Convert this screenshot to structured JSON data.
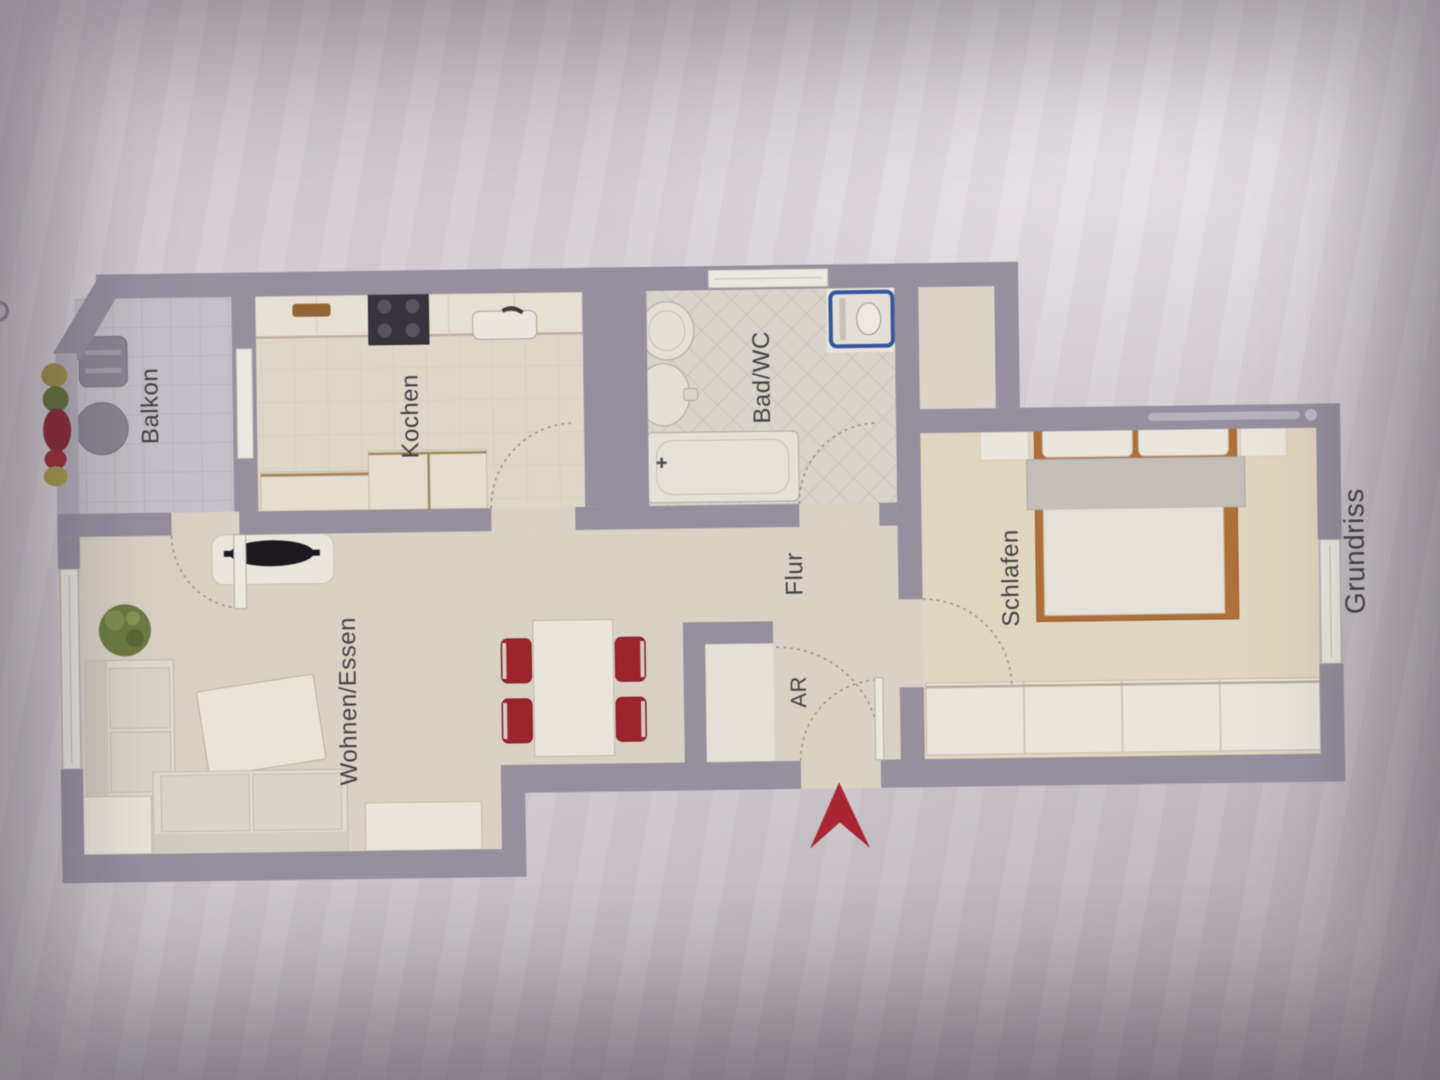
{
  "document": {
    "kind": "apartment-floor-plan-photo",
    "plan_title": "Grundriss"
  },
  "rooms": [
    {
      "id": "balkon",
      "label": "Balkon"
    },
    {
      "id": "kochen",
      "label": "Kochen"
    },
    {
      "id": "bad_wc",
      "label": "Bad/WC"
    },
    {
      "id": "flur",
      "label": "Flur"
    },
    {
      "id": "ar",
      "label": "AR"
    },
    {
      "id": "wohnen",
      "label": "Wohnen/Essen"
    },
    {
      "id": "schlafen",
      "label": "Schlafen"
    }
  ],
  "annotation": {
    "plan_title": "Grundriss"
  },
  "symbols": [
    "balcony-chair",
    "balcony-table",
    "flower-boxes",
    "kitchen-counter",
    "stove",
    "kitchen-sink",
    "cutting-board",
    "duct-shaft",
    "column",
    "bath-sink",
    "toilet",
    "bathtub",
    "washing-machine",
    "tv-lowboard",
    "plant",
    "sofa-left",
    "sofa-bottom",
    "side-table",
    "coffee-table",
    "sideboard",
    "dining-table",
    "red-chairs",
    "storage-closet",
    "entrance-arrow",
    "double-bed",
    "bedside-rugs",
    "wardrobe",
    "door-swing-arcs",
    "windows",
    "illegible-watermark"
  ],
  "colors": {
    "wall": "#968fa0",
    "railing": "#b5afbb",
    "floor_wood": "#ddd5c6",
    "floor_kitchen": "#e2dacb",
    "floor_bath": "#dcd7cd",
    "floor_balcony": "#c7c3ca",
    "floor_bedroom": "#e5dabf",
    "furniture_white": "#efe9dd",
    "accent_red_arrow": "#b3202d",
    "chair_red": "#a61e28",
    "washer_blue": "#2d55a5",
    "bed_frame_wood": "#b56d33",
    "plant_green": "#6b7c3a",
    "tv_black": "#17151a",
    "label_text": "#403c43"
  }
}
